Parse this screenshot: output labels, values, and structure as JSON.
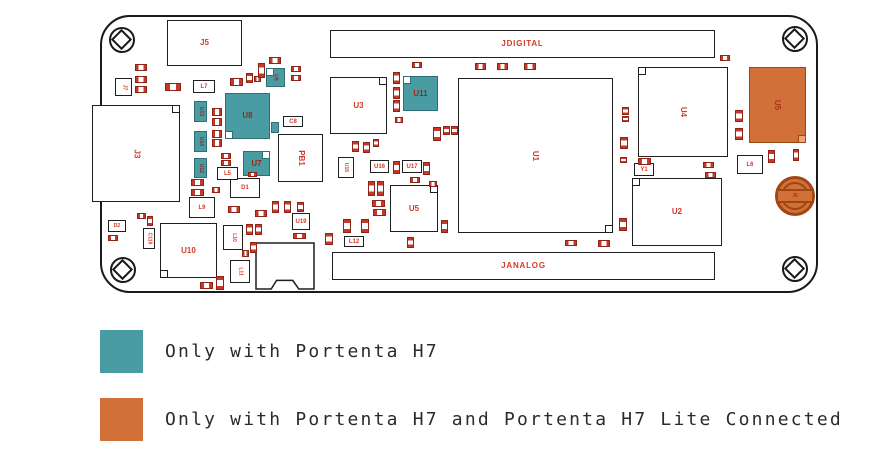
{
  "colors": {
    "teal": "#4A9CA3",
    "orange": "#D2703A",
    "label_red": "#D43A2A",
    "board_outline": "#1a1a1a",
    "chip_border": "#8E2418",
    "chip_pad": "#C23B2A"
  },
  "legend": {
    "items": [
      {
        "color": "#4A9CA3",
        "label": "Only with Portenta H7"
      },
      {
        "color": "#D2703A",
        "label": "Only with Portenta H7 and Portenta H7 Lite Connected"
      }
    ]
  },
  "board": {
    "holes": [
      [
        122,
        40
      ],
      [
        795,
        39
      ],
      [
        123,
        270
      ],
      [
        795,
        269
      ]
    ],
    "battery": {
      "id": "J6",
      "cx": 795,
      "cy": 196,
      "r": 20
    },
    "components": [
      {
        "id": "J5",
        "x": 167,
        "y": 20,
        "w": 75,
        "h": 46,
        "t": "ic",
        "sz": "lg"
      },
      {
        "id": "JDIGITAL",
        "x": 330,
        "y": 30,
        "w": 385,
        "h": 28,
        "t": "ic",
        "sz": "hdr"
      },
      {
        "id": "JANALOG",
        "x": 332,
        "y": 252,
        "w": 383,
        "h": 28,
        "t": "ic",
        "sz": "hdr"
      },
      {
        "id": "J3",
        "x": 92,
        "y": 105,
        "w": 88,
        "h": 97,
        "t": "ic",
        "sz": "lg",
        "rot": 1,
        "notch": "tr"
      },
      {
        "id": "U3",
        "x": 330,
        "y": 77,
        "w": 57,
        "h": 57,
        "t": "ic",
        "sz": "lg",
        "notch": "tr"
      },
      {
        "id": "U1",
        "x": 458,
        "y": 78,
        "w": 155,
        "h": 155,
        "t": "ic",
        "sz": "lg",
        "rot": 1,
        "notch": "br"
      },
      {
        "id": "U4",
        "x": 638,
        "y": 67,
        "w": 90,
        "h": 90,
        "t": "ic",
        "sz": "lg",
        "rot": 1,
        "notch": "tl"
      },
      {
        "id": "U2",
        "x": 632,
        "y": 178,
        "w": 90,
        "h": 68,
        "t": "ic",
        "sz": "lg",
        "notch": "tl"
      },
      {
        "id": "U5",
        "x": 390,
        "y": 185,
        "w": 48,
        "h": 47,
        "t": "ic",
        "sz": "lg",
        "notch": "tr"
      },
      {
        "id": "U10",
        "x": 160,
        "y": 223,
        "w": 57,
        "h": 55,
        "t": "ic",
        "sz": "lg",
        "notch": "bl"
      },
      {
        "id": "J4",
        "x": 255,
        "y": 242,
        "w": 60,
        "h": 48,
        "t": "sd",
        "sz": "md"
      },
      {
        "id": "PB1",
        "x": 278,
        "y": 134,
        "w": 45,
        "h": 48,
        "t": "ic",
        "sz": "lg",
        "rot": 1
      },
      {
        "id": "D1",
        "x": 230,
        "y": 178,
        "w": 30,
        "h": 20,
        "t": "ic",
        "sz": "md"
      },
      {
        "id": "L9",
        "x": 189,
        "y": 197,
        "w": 26,
        "h": 21,
        "t": "ic",
        "sz": "md"
      },
      {
        "id": "L7",
        "x": 193,
        "y": 80,
        "w": 22,
        "h": 13,
        "t": "ic",
        "sz": "md"
      },
      {
        "id": "C8",
        "x": 283,
        "y": 116,
        "w": 20,
        "h": 11,
        "t": "ic",
        "sz": "md"
      },
      {
        "id": "L5",
        "x": 217,
        "y": 167,
        "w": 21,
        "h": 13,
        "t": "ic",
        "sz": "md"
      },
      {
        "id": "U19",
        "x": 292,
        "y": 213,
        "w": 18,
        "h": 17,
        "t": "ic",
        "sz": "md"
      },
      {
        "id": "L10",
        "x": 223,
        "y": 225,
        "w": 20,
        "h": 25,
        "t": "ic",
        "sz": "xs",
        "rot": 1
      },
      {
        "id": "L11",
        "x": 230,
        "y": 260,
        "w": 20,
        "h": 23,
        "t": "ic",
        "sz": "xs",
        "rot": 1
      },
      {
        "id": "C119",
        "x": 143,
        "y": 228,
        "w": 12,
        "h": 21,
        "t": "ic",
        "sz": "xs",
        "rot": 1
      },
      {
        "id": "D2",
        "x": 108,
        "y": 220,
        "w": 18,
        "h": 12,
        "t": "ic",
        "sz": "xs"
      },
      {
        "id": "U15",
        "x": 338,
        "y": 157,
        "w": 16,
        "h": 21,
        "t": "ic",
        "sz": "xs",
        "rot": 1
      },
      {
        "id": "U16",
        "x": 370,
        "y": 160,
        "w": 19,
        "h": 13,
        "t": "ic",
        "sz": "md"
      },
      {
        "id": "U17",
        "x": 402,
        "y": 160,
        "w": 20,
        "h": 13,
        "t": "ic",
        "sz": "md"
      },
      {
        "id": "L12",
        "x": 344,
        "y": 236,
        "w": 20,
        "h": 11,
        "t": "ic",
        "sz": "md"
      },
      {
        "id": "L6",
        "x": 737,
        "y": 155,
        "w": 26,
        "h": 19,
        "t": "ic",
        "sz": "md"
      },
      {
        "id": "Y1",
        "x": 634,
        "y": 163,
        "w": 20,
        "h": 13,
        "t": "ic",
        "sz": "md"
      },
      {
        "id": "J7",
        "x": 115,
        "y": 78,
        "w": 17,
        "h": 18,
        "t": "ic",
        "sz": "xs",
        "rot": 1
      },
      {
        "id": "U8",
        "x": 225,
        "y": 93,
        "w": 45,
        "h": 46,
        "t": "teal",
        "sz": "lg",
        "notch": "bl"
      },
      {
        "id": "U9",
        "x": 266,
        "y": 68,
        "w": 19,
        "h": 19,
        "t": "teal",
        "sz": "xs",
        "rot": 1,
        "notch": "tl"
      },
      {
        "id": "U11",
        "x": 403,
        "y": 76,
        "w": 35,
        "h": 35,
        "t": "teal",
        "sz": "lg",
        "notch": "tl"
      },
      {
        "id": "U13",
        "x": 194,
        "y": 101,
        "w": 13,
        "h": 21,
        "t": "teal",
        "sz": "xs",
        "rot": 1
      },
      {
        "id": "U14",
        "x": 194,
        "y": 131,
        "w": 13,
        "h": 21,
        "t": "teal",
        "sz": "xs",
        "rot": 1
      },
      {
        "id": "U12",
        "x": 194,
        "y": 158,
        "w": 13,
        "h": 20,
        "t": "teal",
        "sz": "xs",
        "rot": 1
      },
      {
        "id": "U7",
        "x": 243,
        "y": 151,
        "w": 27,
        "h": 25,
        "t": "teal",
        "sz": "lg",
        "notch": "tr"
      },
      {
        "id": "",
        "x": 271,
        "y": 122,
        "w": 8,
        "h": 11,
        "t": "teal",
        "sz": "xs"
      },
      {
        "id": "U5",
        "x": 749,
        "y": 67,
        "w": 57,
        "h": 76,
        "t": "orange",
        "sz": "lg",
        "rot": 1,
        "notch": "br"
      }
    ],
    "chips": [
      [
        135,
        64,
        12,
        7
      ],
      [
        135,
        76,
        12,
        7
      ],
      [
        135,
        86,
        12,
        7
      ],
      [
        165,
        83,
        16,
        8
      ],
      [
        230,
        78,
        13,
        8
      ],
      [
        246,
        73,
        7,
        10,
        1
      ],
      [
        254,
        76,
        7,
        6
      ],
      [
        258,
        63,
        7,
        15,
        1
      ],
      [
        269,
        57,
        12,
        7
      ],
      [
        291,
        66,
        10,
        6
      ],
      [
        291,
        75,
        10,
        6
      ],
      [
        212,
        108,
        10,
        8
      ],
      [
        212,
        118,
        10,
        8
      ],
      [
        212,
        130,
        10,
        8
      ],
      [
        212,
        139,
        10,
        8
      ],
      [
        221,
        153,
        10,
        6
      ],
      [
        221,
        160,
        10,
        6
      ],
      [
        191,
        179,
        13,
        7
      ],
      [
        191,
        189,
        13,
        7
      ],
      [
        212,
        187,
        8,
        6
      ],
      [
        248,
        172,
        9,
        5
      ],
      [
        352,
        141,
        7,
        11,
        1
      ],
      [
        363,
        142,
        7,
        11,
        1
      ],
      [
        373,
        139,
        6,
        8,
        1
      ],
      [
        412,
        62,
        10,
        6
      ],
      [
        393,
        72,
        7,
        12,
        1
      ],
      [
        393,
        87,
        7,
        12,
        1
      ],
      [
        393,
        100,
        7,
        12,
        1
      ],
      [
        395,
        117,
        8,
        6
      ],
      [
        433,
        127,
        8,
        14,
        1
      ],
      [
        443,
        126,
        7,
        9,
        1
      ],
      [
        451,
        126,
        7,
        9,
        1
      ],
      [
        475,
        63,
        11,
        7
      ],
      [
        497,
        63,
        11,
        7
      ],
      [
        524,
        63,
        12,
        7
      ],
      [
        393,
        161,
        7,
        13,
        1
      ],
      [
        423,
        162,
        7,
        13,
        1
      ],
      [
        410,
        177,
        10,
        6
      ],
      [
        368,
        181,
        7,
        15,
        1
      ],
      [
        377,
        181,
        7,
        15,
        1
      ],
      [
        429,
        181,
        8,
        6
      ],
      [
        372,
        200,
        13,
        7
      ],
      [
        373,
        209,
        13,
        7
      ],
      [
        343,
        219,
        8,
        14,
        1
      ],
      [
        361,
        219,
        8,
        14,
        1
      ],
      [
        407,
        237,
        7,
        11,
        1
      ],
      [
        441,
        220,
        7,
        13,
        1
      ],
      [
        137,
        213,
        9,
        6
      ],
      [
        147,
        216,
        6,
        10,
        1
      ],
      [
        108,
        235,
        10,
        6
      ],
      [
        228,
        206,
        12,
        7
      ],
      [
        255,
        210,
        12,
        7
      ],
      [
        272,
        201,
        7,
        12,
        1
      ],
      [
        284,
        201,
        7,
        12,
        1
      ],
      [
        297,
        202,
        7,
        10,
        1
      ],
      [
        293,
        233,
        13,
        6
      ],
      [
        246,
        224,
        7,
        11,
        1
      ],
      [
        255,
        224,
        7,
        11,
        1
      ],
      [
        250,
        242,
        7,
        11,
        1
      ],
      [
        242,
        250,
        7,
        7
      ],
      [
        200,
        282,
        13,
        7
      ],
      [
        216,
        276,
        8,
        14,
        1
      ],
      [
        325,
        233,
        8,
        12,
        1
      ],
      [
        622,
        107,
        7,
        8,
        1
      ],
      [
        622,
        116,
        7,
        6,
        1
      ],
      [
        620,
        137,
        8,
        12,
        1
      ],
      [
        620,
        157,
        7,
        6,
        1
      ],
      [
        619,
        218,
        8,
        13,
        1
      ],
      [
        638,
        158,
        13,
        7
      ],
      [
        703,
        162,
        11,
        6
      ],
      [
        705,
        172,
        11,
        6
      ],
      [
        720,
        55,
        10,
        6
      ],
      [
        735,
        110,
        8,
        12,
        1
      ],
      [
        735,
        128,
        8,
        12,
        1
      ],
      [
        768,
        150,
        7,
        13,
        1
      ],
      [
        793,
        149,
        6,
        12,
        1
      ],
      [
        565,
        240,
        12,
        6
      ],
      [
        598,
        240,
        12,
        7
      ]
    ]
  }
}
